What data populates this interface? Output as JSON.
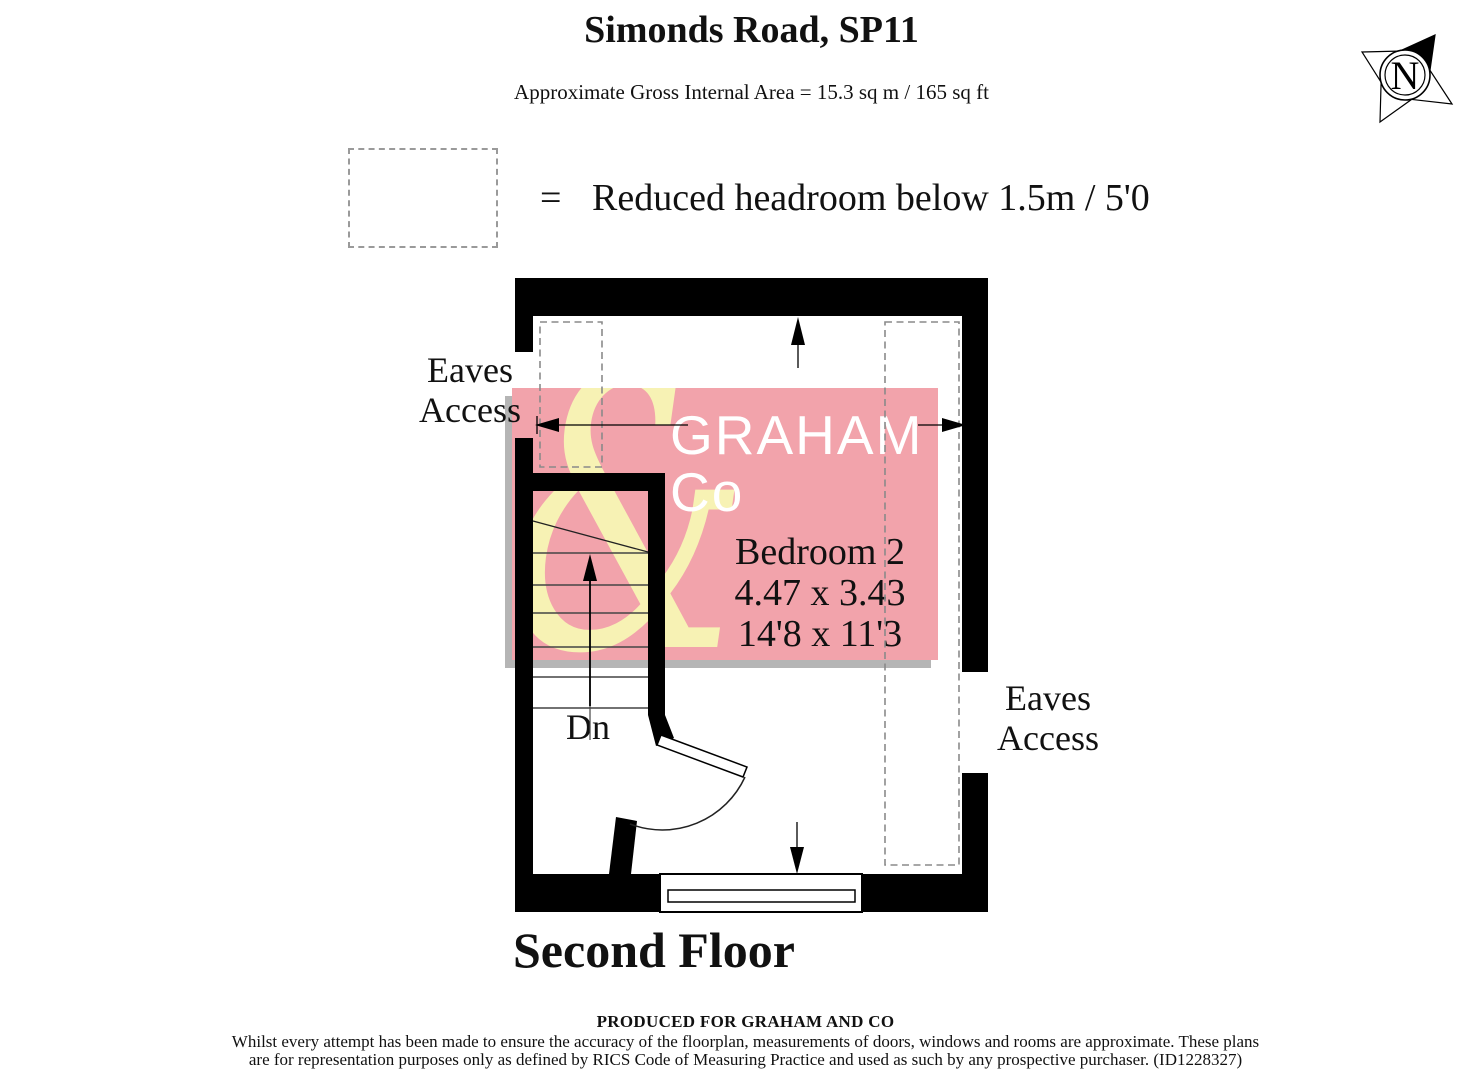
{
  "title": "Simonds Road, SP11",
  "subtitle": "Approximate Gross Internal Area = 15.3 sq m / 165 sq ft",
  "legend": {
    "equals_sign": "=",
    "label": "Reduced headroom below 1.5m / 5'0"
  },
  "compass": {
    "letter": "N"
  },
  "watermark": {
    "ampersand": "&",
    "line1": "GRAHAM",
    "line2": "Co",
    "colors": {
      "pink": "#F2A3AB",
      "yellow": "#F7F2B4",
      "shadow": "#B5B5B5"
    }
  },
  "plan": {
    "room": {
      "name": "Bedroom 2",
      "dimensions_metric": "4.47 x 3.43",
      "dimensions_imperial": "14'8 x 11'3"
    },
    "eaves_access_left": {
      "line1": "Eaves",
      "line2": "Access"
    },
    "eaves_access_right": {
      "line1": "Eaves",
      "line2": "Access"
    },
    "stairs_label": "Dn"
  },
  "floor_label": "Second Floor",
  "footer": {
    "produced_for": "PRODUCED FOR GRAHAM AND CO",
    "disclaimer_line1": "Whilst every attempt has been made to ensure the accuracy of the floorplan, measurements of doors, windows and rooms are approximate. These plans",
    "disclaimer_line2": "are for representation purposes only as defined by RICS Code of Measuring Practice and used as such by any prospective purchaser. (ID1228327)"
  }
}
